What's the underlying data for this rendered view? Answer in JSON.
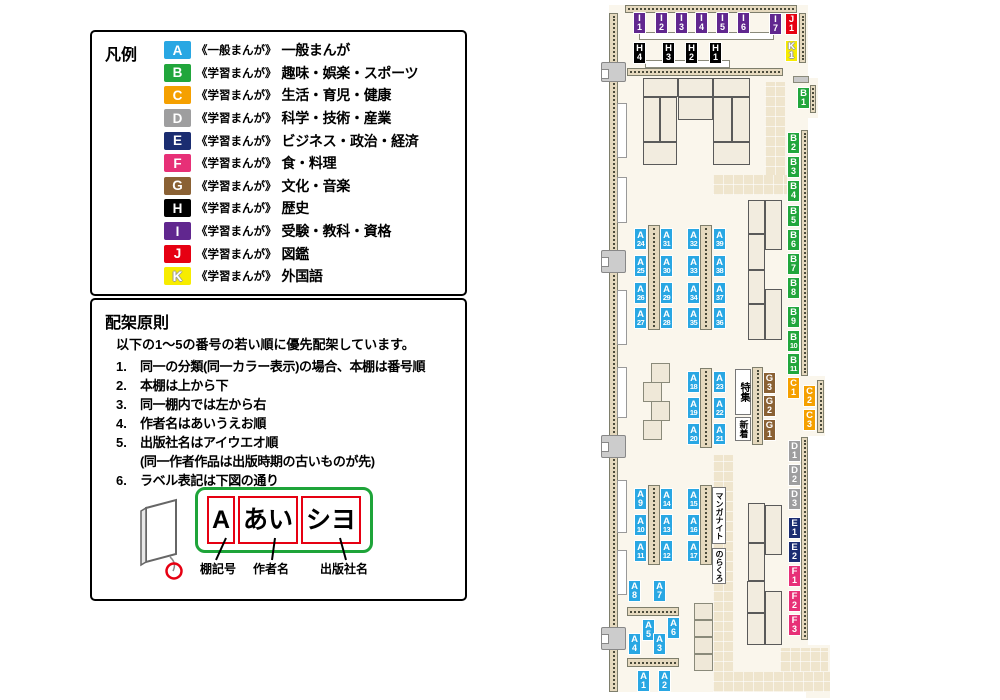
{
  "palette": {
    "A": "#29A7E3",
    "B": "#21A63C",
    "C": "#F5A000",
    "D": "#9E9E9F",
    "E": "#1B2D71",
    "F": "#E73077",
    "G": "#8A6134",
    "H": "#000000",
    "I": "#61278F",
    "J": "#E60012",
    "K": "#F7EC00"
  },
  "legend": {
    "title": "凡例",
    "items": [
      {
        "code": "A",
        "series": "《一般まんが》",
        "label": "一般まんが"
      },
      {
        "code": "B",
        "series": "《学習まんが》",
        "label": "趣味・娯楽・スポーツ"
      },
      {
        "code": "C",
        "series": "《学習まんが》",
        "label": "生活・育児・健康"
      },
      {
        "code": "D",
        "series": "《学習まんが》",
        "label": "科学・技術・産業"
      },
      {
        "code": "E",
        "series": "《学習まんが》",
        "label": "ビジネス・政治・経済"
      },
      {
        "code": "F",
        "series": "《学習まんが》",
        "label": "食・料理"
      },
      {
        "code": "G",
        "series": "《学習まんが》",
        "label": "文化・音楽"
      },
      {
        "code": "H",
        "series": "《学習まんが》",
        "label": "歴史"
      },
      {
        "code": "I",
        "series": "《学習まんが》",
        "label": "受験・教科・資格"
      },
      {
        "code": "J",
        "series": "《学習まんが》",
        "label": "図鑑"
      },
      {
        "code": "K",
        "series": "《学習まんが》",
        "label": "外国語"
      }
    ]
  },
  "principles": {
    "title": "配架原則",
    "intro": "以下の1〜5の番号の若い順に優先配架しています。",
    "items": [
      {
        "num": "1.",
        "text": "同一の分類(同一カラー表示)の場合、本棚は番号順"
      },
      {
        "num": "2.",
        "text": "本棚は上から下"
      },
      {
        "num": "3.",
        "text": "同一棚内では左から右"
      },
      {
        "num": "4.",
        "text": "作者名はあいうえお順"
      },
      {
        "num": "5.",
        "text": "出版社名はアイウエオ順",
        "note": "(同一作者作品は出版時期の古いものが先)"
      },
      {
        "num": "6.",
        "text": "ラベル表記は下図の通り"
      }
    ]
  },
  "label_diagram": {
    "boxes": [
      "A",
      "あい",
      "シヨ"
    ],
    "captions": [
      "棚記号",
      "作者名",
      "出版社名"
    ]
  },
  "map": {
    "labels": [
      {
        "code": "I1",
        "x": 633,
        "y": 12
      },
      {
        "code": "I2",
        "x": 655,
        "y": 12
      },
      {
        "code": "I3",
        "x": 675,
        "y": 12
      },
      {
        "code": "I4",
        "x": 695,
        "y": 12
      },
      {
        "code": "I5",
        "x": 716,
        "y": 12
      },
      {
        "code": "I6",
        "x": 737,
        "y": 12
      },
      {
        "code": "I7",
        "x": 769,
        "y": 13
      },
      {
        "code": "J1",
        "x": 785,
        "y": 13
      },
      {
        "code": "K1",
        "x": 785,
        "y": 40
      },
      {
        "code": "H4",
        "x": 633,
        "y": 42
      },
      {
        "code": "H3",
        "x": 662,
        "y": 42
      },
      {
        "code": "H2",
        "x": 685,
        "y": 42
      },
      {
        "code": "H1",
        "x": 709,
        "y": 42
      },
      {
        "code": "B1",
        "x": 797,
        "y": 87
      },
      {
        "code": "B2",
        "x": 787,
        "y": 132
      },
      {
        "code": "B3",
        "x": 787,
        "y": 156
      },
      {
        "code": "B4",
        "x": 787,
        "y": 180
      },
      {
        "code": "B5",
        "x": 787,
        "y": 205
      },
      {
        "code": "B6",
        "x": 787,
        "y": 229
      },
      {
        "code": "B7",
        "x": 787,
        "y": 253
      },
      {
        "code": "B8",
        "x": 787,
        "y": 277
      },
      {
        "code": "B9",
        "x": 787,
        "y": 306
      },
      {
        "code": "B10",
        "x": 787,
        "y": 330
      },
      {
        "code": "B11",
        "x": 787,
        "y": 353
      },
      {
        "code": "C1",
        "x": 787,
        "y": 377
      },
      {
        "code": "C2",
        "x": 803,
        "y": 385
      },
      {
        "code": "C3",
        "x": 803,
        "y": 409
      },
      {
        "code": "D1",
        "x": 788,
        "y": 440
      },
      {
        "code": "D2",
        "x": 788,
        "y": 464
      },
      {
        "code": "D3",
        "x": 788,
        "y": 488
      },
      {
        "code": "E1",
        "x": 788,
        "y": 517
      },
      {
        "code": "E2",
        "x": 788,
        "y": 541
      },
      {
        "code": "F1",
        "x": 788,
        "y": 565
      },
      {
        "code": "F2",
        "x": 788,
        "y": 590
      },
      {
        "code": "F3",
        "x": 788,
        "y": 614
      },
      {
        "code": "A24",
        "x": 634,
        "y": 228
      },
      {
        "code": "A31",
        "x": 660,
        "y": 228
      },
      {
        "code": "A25",
        "x": 634,
        "y": 255
      },
      {
        "code": "A30",
        "x": 660,
        "y": 255
      },
      {
        "code": "A26",
        "x": 634,
        "y": 282
      },
      {
        "code": "A29",
        "x": 660,
        "y": 282
      },
      {
        "code": "A27",
        "x": 634,
        "y": 307
      },
      {
        "code": "A28",
        "x": 660,
        "y": 307
      },
      {
        "code": "A32",
        "x": 687,
        "y": 228
      },
      {
        "code": "A39",
        "x": 713,
        "y": 228
      },
      {
        "code": "A33",
        "x": 687,
        "y": 255
      },
      {
        "code": "A38",
        "x": 713,
        "y": 255
      },
      {
        "code": "A34",
        "x": 687,
        "y": 282
      },
      {
        "code": "A37",
        "x": 713,
        "y": 282
      },
      {
        "code": "A35",
        "x": 687,
        "y": 307
      },
      {
        "code": "A36",
        "x": 713,
        "y": 307
      },
      {
        "code": "A18",
        "x": 687,
        "y": 371
      },
      {
        "code": "A23",
        "x": 713,
        "y": 371
      },
      {
        "code": "A19",
        "x": 687,
        "y": 397
      },
      {
        "code": "A22",
        "x": 713,
        "y": 397
      },
      {
        "code": "A20",
        "x": 687,
        "y": 423
      },
      {
        "code": "A21",
        "x": 713,
        "y": 423
      },
      {
        "code": "G3",
        "x": 763,
        "y": 372
      },
      {
        "code": "G2",
        "x": 763,
        "y": 395
      },
      {
        "code": "G1",
        "x": 763,
        "y": 419
      },
      {
        "code": "A9",
        "x": 634,
        "y": 488
      },
      {
        "code": "A14",
        "x": 660,
        "y": 488
      },
      {
        "code": "A10",
        "x": 634,
        "y": 514
      },
      {
        "code": "A13",
        "x": 660,
        "y": 514
      },
      {
        "code": "A11",
        "x": 634,
        "y": 540
      },
      {
        "code": "A12",
        "x": 660,
        "y": 540
      },
      {
        "code": "A15",
        "x": 687,
        "y": 488
      },
      {
        "code": "A16",
        "x": 687,
        "y": 514
      },
      {
        "code": "A17",
        "x": 687,
        "y": 540
      },
      {
        "code": "A8",
        "x": 628,
        "y": 580
      },
      {
        "code": "A7",
        "x": 653,
        "y": 580
      },
      {
        "code": "A5",
        "x": 642,
        "y": 619
      },
      {
        "code": "A6",
        "x": 667,
        "y": 617
      },
      {
        "code": "A4",
        "x": 628,
        "y": 633
      },
      {
        "code": "A3",
        "x": 653,
        "y": 633
      },
      {
        "code": "A1",
        "x": 637,
        "y": 670
      },
      {
        "code": "A2",
        "x": 658,
        "y": 670
      }
    ],
    "texts": [
      {
        "name": "feature-box",
        "text": "特集",
        "x": 735,
        "y": 369,
        "w": 16,
        "h": 46,
        "fs": 10
      },
      {
        "name": "new-arrivals-box",
        "text": "新着",
        "x": 735,
        "y": 417,
        "w": 16,
        "h": 24,
        "fs": 9
      },
      {
        "name": "manga-night-box",
        "text": "マンガナイト",
        "x": 712,
        "y": 487,
        "w": 14,
        "h": 57,
        "fs": 8
      },
      {
        "name": "norakuro-box",
        "text": "のらくろ",
        "x": 712,
        "y": 548,
        "w": 14,
        "h": 36,
        "fs": 8
      }
    ]
  }
}
